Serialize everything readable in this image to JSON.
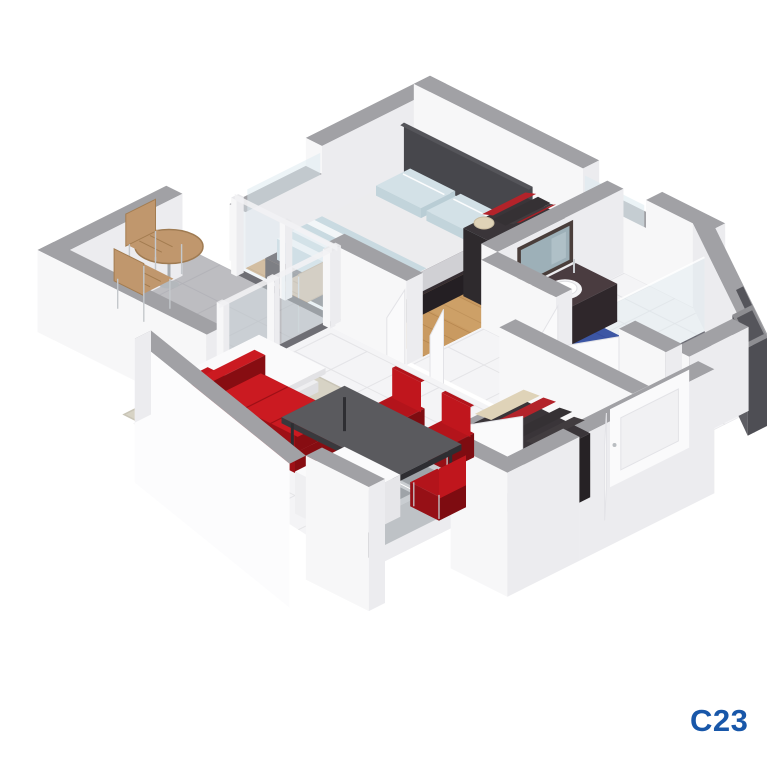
{
  "page": {
    "background": "#FFFFFF",
    "description": "3d-isometric-apartment-floorplan-render"
  },
  "label": {
    "text": "C23",
    "color": "#1857A9"
  },
  "scene": {
    "rooms": [
      "bedroom",
      "bathroom",
      "hallway",
      "entry",
      "living-room",
      "kitchenette",
      "balcony"
    ],
    "furniture": [
      "double-bed",
      "headboard-panel",
      "wardrobe",
      "mirror",
      "vanity-sink",
      "toilet",
      "shower",
      "bath-mat",
      "red-sofa",
      "coffee-table",
      "rug",
      "dining-table",
      "red-chairs",
      "kitchen-counter",
      "kitchen-cabinet",
      "entry-closet",
      "balcony-table",
      "balcony-chairs",
      "front-door"
    ]
  },
  "colors": {
    "wallTop": "#A1A1A5",
    "wallBright": "#F7F7F8",
    "wallShade": "#ECECEF",
    "wallOuter": "#FCFCFD",
    "wood": "#C99A61",
    "woodLine": "#B2824C",
    "woodLight": "#D8B077",
    "tile": "#F4F4F6",
    "tileLine": "#E2E2E6",
    "balconyFloor": "#BDBDC1",
    "balconyLine": "#B2B2B6",
    "trackDark": "#6E6E74",
    "glassPane": "#DFECF1",
    "glassSill": "#DEEBF0",
    "rug": "#D7D3C5",
    "rugEdge": "#C9C5B7",
    "sofaRed": "#C2161D",
    "sofaShade": "#9E1016",
    "sofaDark": "#870D12",
    "cushion": "#CB1A21",
    "tableTop": "#5A5A5E",
    "tableSide": "#39393D",
    "chairRed": "#B3141B",
    "chairBack": "#C0161D",
    "bedFrame": "#362E33",
    "bedFrameShade": "#241F23",
    "headboard": "#47474C",
    "mattress": "#ECECEE",
    "mattressSide": "#D9D9DC",
    "stripeBlue": "#C9DAE1",
    "stripeFaint": "#F2F6F8",
    "pillow": "#D3E1E7",
    "wardrobeDark": "#3A3539",
    "clothesBeige": "#DFD3B8",
    "clothesRed": "#B3232A",
    "clothesDark": "#353134",
    "mirrorFrame": "#4A3E3B",
    "mirrorGlass": "#9DB0B8",
    "vanityTop": "#4A3C40",
    "vanityFace": "#382E32",
    "vanityFace2": "#2F272B",
    "porcelain": "#FBFBFC",
    "porcelainShade": "#E9E9EC",
    "matBlue": "#3C56A4",
    "showerFloor": "#73737B",
    "showerLine": "#62626A",
    "shaftTop": "#8E8E92",
    "shaftDark": "#55555B",
    "shaftFace": "#5E5E64",
    "steel": "#C9CDD1",
    "steelDark": "#9EA3A8",
    "doorWhite": "#FAFAFB",
    "doorEdge": "#E3E3E7",
    "woodFurn": "#C0976D",
    "woodFurnLine": "#A37C50",
    "metal": "#C4C8CC"
  }
}
